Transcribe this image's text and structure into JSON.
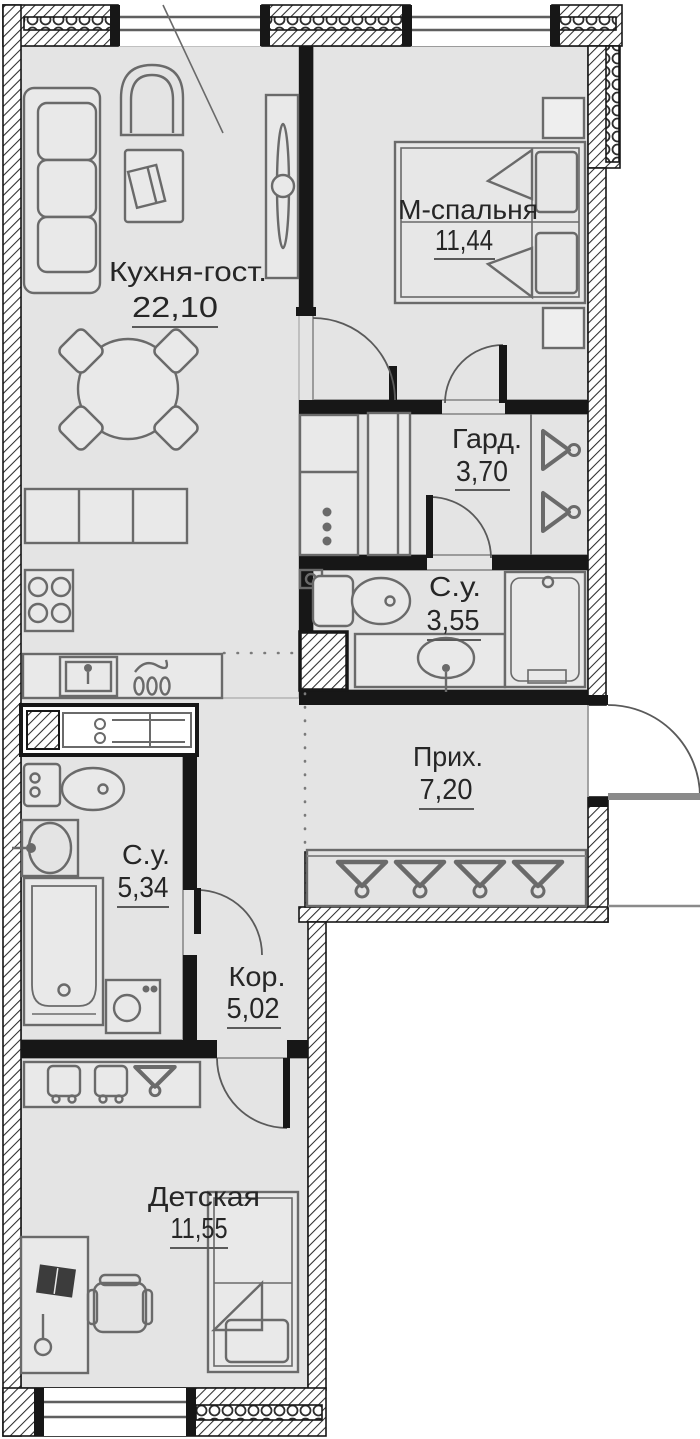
{
  "plan": {
    "type": "apartment-floor-plan",
    "rooms": [
      {
        "key": "kitchen_living",
        "label": "Кухня-гост.",
        "area": "22,10"
      },
      {
        "key": "master_bedroom",
        "label": "М-спальня",
        "area": "11,44"
      },
      {
        "key": "wardrobe",
        "label": "Гард.",
        "area": "3,70"
      },
      {
        "key": "master_bathroom",
        "label": "С.у.",
        "area": "3,55"
      },
      {
        "key": "hallway",
        "label": "Прих.",
        "area": "7,20"
      },
      {
        "key": "bathroom",
        "label": "С.у.",
        "area": "5,34"
      },
      {
        "key": "corridor",
        "label": "Кор.",
        "area": "5,02"
      },
      {
        "key": "kids_room",
        "label": "Детская",
        "area": "11,55"
      }
    ],
    "furniture_icons": [
      "sofa-icon",
      "armchair-icon",
      "coffee-table-icon",
      "tv-console-icon",
      "dining-table-icon",
      "dining-chair-icon",
      "kitchen-cabinets-icon",
      "stove-icon",
      "kitchen-sink-icon",
      "dish-rack-icon",
      "double-bed-icon",
      "nightstand-icon",
      "tall-cabinet-icon",
      "hanger-icon",
      "toilet-icon",
      "shower-icon",
      "vanity-sink-icon",
      "duct-shaft-icon",
      "closet-hanger-icon",
      "wash-basin-icon",
      "bathtub-icon",
      "washing-machine-icon",
      "wardrobe-drawers-icon",
      "desk-icon",
      "desk-chair-icon",
      "desk-lamp-icon",
      "single-bed-icon",
      "entrance-door-icon",
      "door-swing-icon",
      "window-icon"
    ],
    "colors": {
      "floor": "#e4e4e4",
      "wall": "#171717",
      "hatch_line": "#2d2d2d",
      "furniture_line": "#6a6a6a",
      "text": "#262626",
      "underline": "#5a5a5a",
      "outside": "#ffffff"
    }
  }
}
